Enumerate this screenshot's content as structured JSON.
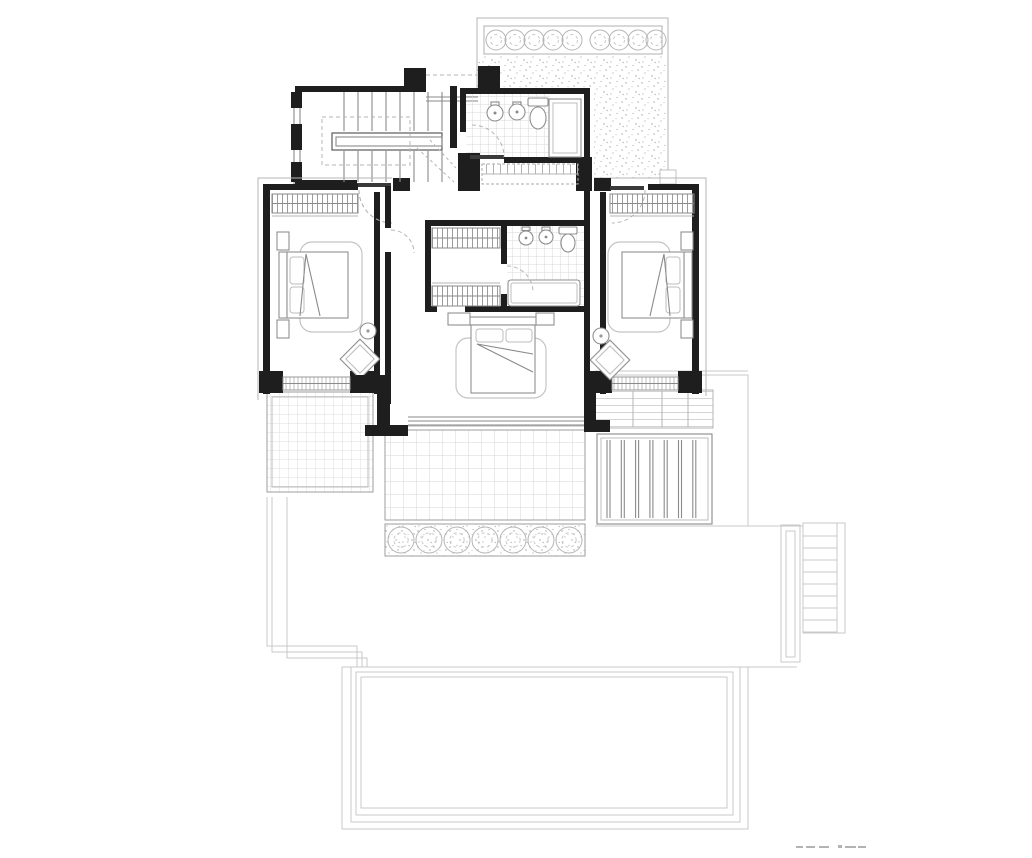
{
  "document": {
    "type": "architectural-floor-plan",
    "level": "upper-bedroom-floor",
    "visible_text": "none (footer scale marks illegible)"
  },
  "palette": {
    "wall": "#1e1e1e",
    "fixture_line": "#8a8a8a",
    "light_line": "#b5b5b5",
    "underlay_line": "#c9c9c9",
    "pattern_line": "#d9d9d9",
    "stipple_dot": "#a3a3a3",
    "background": "#ffffff"
  },
  "rooms": [
    {
      "name": "stair-hall",
      "features": [
        "u-shaped-stair",
        "dashed-handrail",
        "window-wall"
      ]
    },
    {
      "name": "family-bathroom",
      "features": [
        "washbasin",
        "washbasin",
        "toilet",
        "shower",
        "tiled-floor",
        "built-in-wardrobe",
        "door-swing"
      ]
    },
    {
      "name": "upper-terrace",
      "features": [
        "hedge-planter",
        "gravel-surface"
      ]
    },
    {
      "name": "bedroom-left",
      "features": [
        "built-in-wardrobe",
        "double-bed",
        "rug",
        "nightstand",
        "nightstand",
        "side-table",
        "armchair",
        "window-band"
      ]
    },
    {
      "name": "master-suite",
      "features": [
        "walk-in-closet",
        "wardrobe",
        "wardrobe",
        "ensuite-bathroom",
        "washbasin",
        "washbasin",
        "toilet",
        "bathtub",
        "double-bed",
        "rug",
        "nightstand",
        "nightstand",
        "glazed-wall"
      ]
    },
    {
      "name": "bedroom-right",
      "features": [
        "built-in-wardrobe",
        "double-bed",
        "rug",
        "nightstand",
        "nightstand",
        "side-table",
        "armchair",
        "window-band"
      ]
    },
    {
      "name": "terrace-left",
      "features": [
        "tiled-paving"
      ]
    },
    {
      "name": "terrace-center",
      "features": [
        "tiled-paving",
        "hedge-planter"
      ]
    },
    {
      "name": "terrace-right",
      "features": [
        "tiled-paving",
        "timber-deck"
      ]
    },
    {
      "name": "lower-level-underlay",
      "features": [
        "external-stair",
        "handrail",
        "nested-terrace-outline"
      ]
    }
  ],
  "geometry": {
    "stair_upper_flight": {
      "x1": 344,
      "x2": 442,
      "step": 14,
      "y1": 92,
      "y2": 131
    },
    "stair_lower_flight": {
      "x1": 344,
      "x2": 442,
      "step": 14,
      "y1": 151,
      "y2": 182
    },
    "ext_stair_treads": {
      "x1": 803,
      "x2": 837,
      "y1": 536,
      "y2": 632,
      "step": 12
    },
    "deck_slats": {
      "count": 7,
      "x0": 607,
      "dx": 14.3,
      "gap": 3,
      "y1": 440,
      "y2": 518
    },
    "bushes_top": {
      "cy": 40,
      "r": 10,
      "xs": [
        496,
        515,
        534,
        553,
        572,
        600,
        619,
        638,
        656
      ]
    },
    "bushes_bottom": {
      "cy": 540,
      "r": 13,
      "xs": [
        401,
        429,
        457,
        485,
        513,
        541,
        569
      ]
    },
    "tile_dividers_right": {
      "y1": 391,
      "y2": 427,
      "xs": [
        633,
        662,
        688
      ]
    },
    "pool_rings": [
      [
        342,
        667,
        406,
        162
      ],
      [
        351,
        667,
        389,
        155
      ],
      [
        356,
        672,
        377,
        143
      ],
      [
        361,
        677,
        366,
        131
      ]
    ],
    "footer_marks": [
      [
        796,
        846,
        7,
        2
      ],
      [
        806,
        846,
        9,
        2
      ],
      [
        819,
        846,
        10,
        2
      ],
      [
        838,
        845,
        4,
        3
      ],
      [
        845,
        846,
        11,
        2
      ],
      [
        858,
        846,
        8,
        2
      ]
    ]
  }
}
